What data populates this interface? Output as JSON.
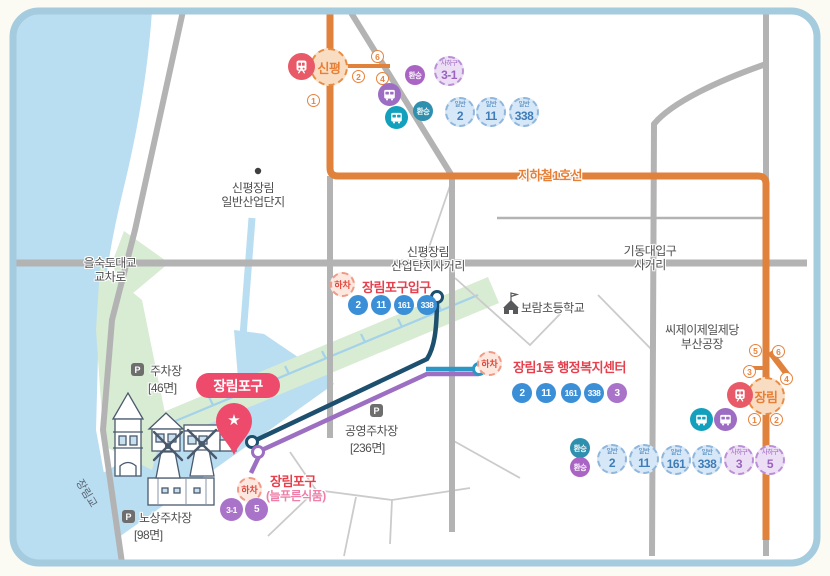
{
  "subway": {
    "line_label": "지하철1호선",
    "stations": {
      "sinpyeong": {
        "name": "신평",
        "exits": {
          "e1": "1",
          "e2": "2",
          "e4": "4",
          "e6": "6"
        }
      },
      "jangnim": {
        "name": "장림",
        "exits": {
          "e1": "1",
          "e2": "2",
          "e3": "3",
          "e4": "4",
          "e5": "5",
          "e6": "6"
        }
      }
    }
  },
  "transfer_label": "환승",
  "alight_label": "하차",
  "badges": {
    "sinpyeong": {
      "saha31": {
        "region": "사하구",
        "num": "3-1"
      },
      "g2": {
        "type": "일반",
        "num": "2"
      },
      "g11": {
        "type": "일반",
        "num": "11"
      },
      "g338": {
        "type": "일반",
        "num": "338"
      }
    },
    "jangnim": {
      "g2": {
        "type": "일반",
        "num": "2"
      },
      "g11": {
        "type": "일반",
        "num": "11"
      },
      "g161": {
        "type": "일반",
        "num": "161"
      },
      "g338": {
        "type": "일반",
        "num": "338"
      },
      "s3": {
        "region": "사하구",
        "num": "3"
      },
      "s5": {
        "region": "사하구",
        "num": "5"
      }
    }
  },
  "stops": {
    "ipgu": {
      "name": "장림포구입구",
      "buses": [
        "2",
        "11",
        "161",
        "338"
      ]
    },
    "admin": {
      "name": "장림1동 행정복지센터",
      "buses": [
        "2",
        "11",
        "161",
        "338"
      ],
      "purple_bus": "3"
    },
    "pogu": {
      "name": "장림포구",
      "sub": "(늘푸른식품)",
      "purple_buses": [
        "3-1",
        "5"
      ]
    }
  },
  "places": {
    "industrial": {
      "line1": "신평장림",
      "line2": "일반산업단지"
    },
    "eulsukdo": {
      "line1": "을숙도대교",
      "line2": "교차로"
    },
    "sanup": {
      "line1": "신평장림",
      "line2": "산업단지사거리"
    },
    "gidong": {
      "line1": "기동대입구",
      "line2": "사거리"
    },
    "school": "보람초등학교",
    "cj": {
      "line1": "씨제이제일제당",
      "line2": "부산공장"
    },
    "bridge": "장림교"
  },
  "parking": {
    "icon": "P",
    "p46": {
      "name": "주차장",
      "capacity": "[46면]"
    },
    "p236": {
      "name": "공영주차장",
      "capacity": "[236면]"
    },
    "p98": {
      "name": "노상주차장",
      "capacity": "[98면]"
    }
  },
  "main": {
    "label": "장림포구",
    "star": "★"
  },
  "colors": {
    "subway_orange": "#e0813c",
    "route_navy": "#1d4f6e",
    "route_blue": "#2a97c4",
    "route_purple": "#9c6fc2",
    "stop_red": "#e5404d",
    "bus_blue": "#3b8fd6",
    "bus_purple": "#a873c8",
    "transfer_teal": "#2e8fae",
    "transfer_purple": "#a964c4",
    "water": "#b9ddf1",
    "park_green": "#d8ebd3",
    "pin_pink": "#ee4b6c",
    "frame_blue": "#a5cbdf"
  }
}
